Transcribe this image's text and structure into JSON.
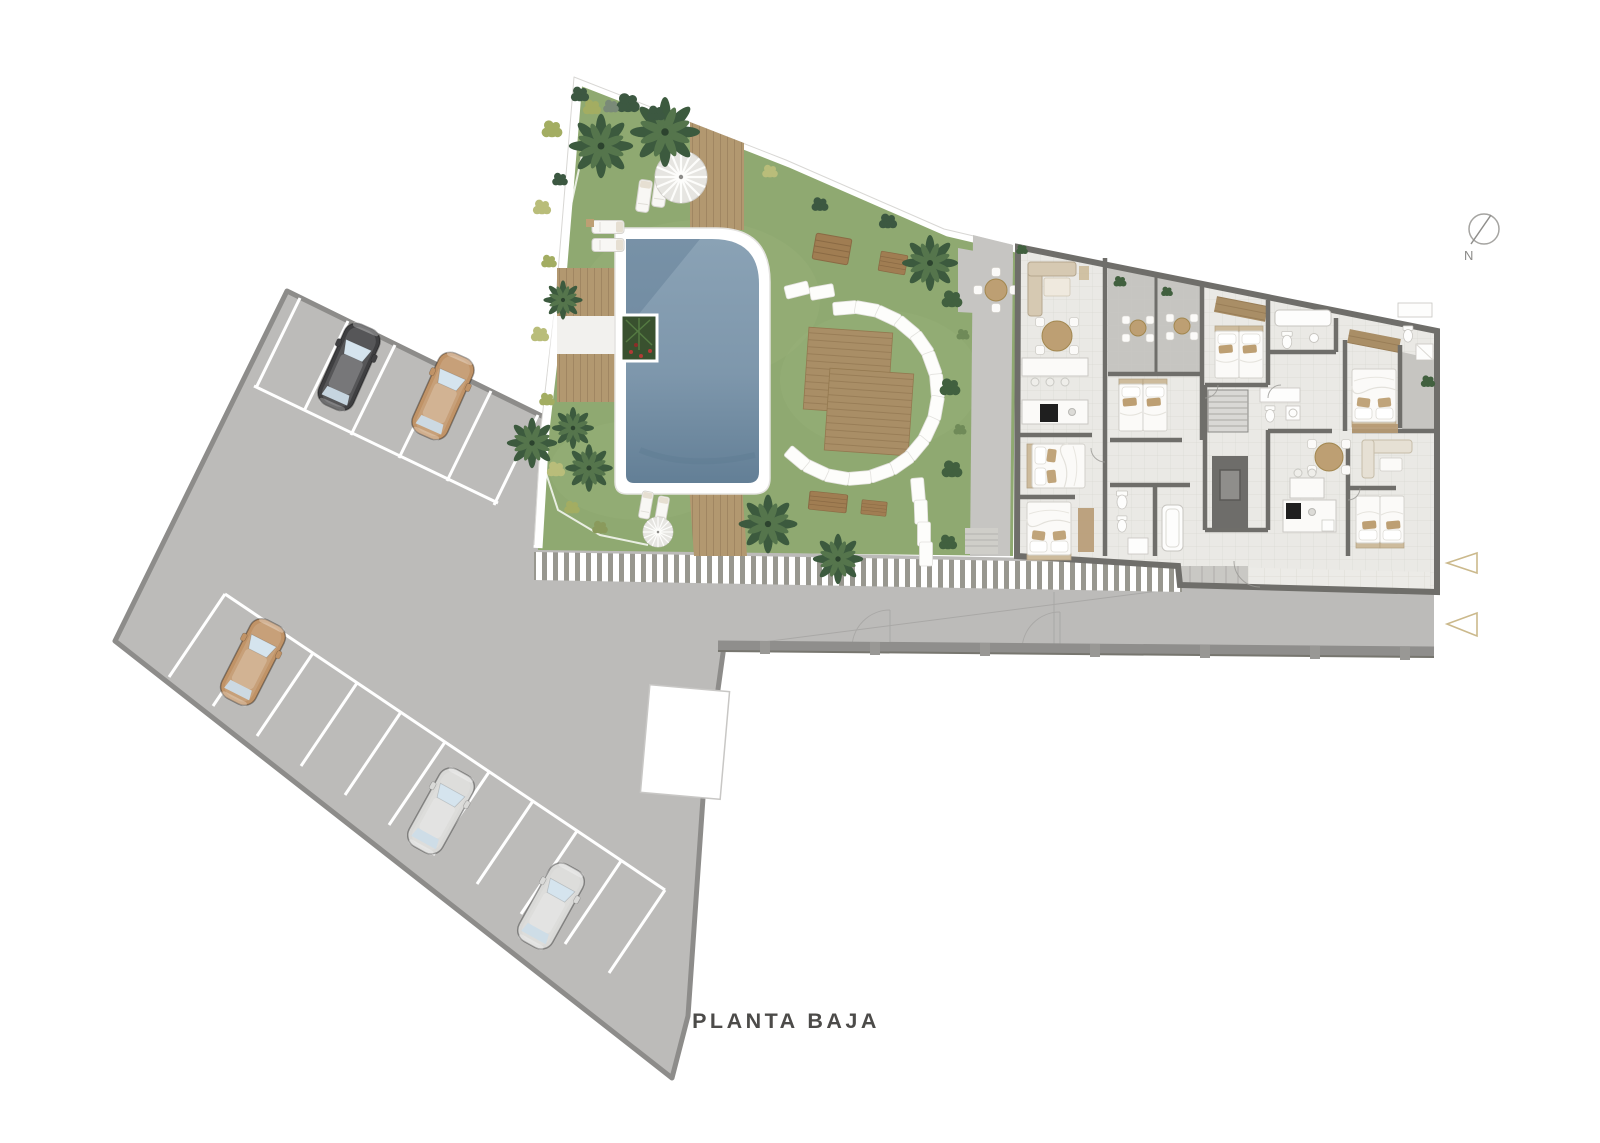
{
  "title": {
    "text": "PLANTA BAJA"
  },
  "compass": {
    "label": "N"
  },
  "palette": {
    "bg": "#ffffff",
    "title-color": "#4c4b49",
    "compass-color": "#8b8a88",
    "asphalt": "#bcbbb9",
    "asphalt_border": "#8d8c8a",
    "parking_line": "#ffffff",
    "lawn": "#8fa971",
    "gravel_path": "#c6c5c2",
    "deck_wood": "#b29870",
    "pool_water": "#7e97ac",
    "pool_coping": "#ffffff",
    "fence_stripe": "#98978f",
    "building_wall": "#6f6e6a",
    "building_floor": "#eae9e5",
    "terrace_floor": "#c6c5c1",
    "furniture_beige": "#d6c9b2",
    "furniture_tan": "#bd9f73",
    "palm_green": "#3c5a3e",
    "shrub_green": "#a3ad62",
    "stepping_stone": "#fdfdfb",
    "entrance_arrow": "#cbb98c",
    "car_dark": "#3f3f41",
    "car_tan": "#c09367",
    "car_silver": "#d9d9d7"
  },
  "parking": {
    "rows": [
      {
        "name": "top-row",
        "spaces": 6
      },
      {
        "name": "side-row",
        "spaces": 11
      }
    ],
    "cars": [
      {
        "id": "car-1",
        "color_name": "dark-gray",
        "hex": "#3f3f41"
      },
      {
        "id": "car-2",
        "color_name": "tan",
        "hex": "#c09367"
      },
      {
        "id": "car-3",
        "color_name": "tan",
        "hex": "#c09367"
      },
      {
        "id": "car-4",
        "color_name": "silver",
        "hex": "#d9d9d7"
      },
      {
        "id": "car-5",
        "color_name": "silver",
        "hex": "#d9d9d7"
      }
    ]
  },
  "garden": {
    "features": [
      "swimming-pool",
      "wood-deck-paths",
      "wood-platforms",
      "stepping-stone-arc",
      "parasols",
      "sun-loungers",
      "wood-benches",
      "palm-trees",
      "shrubs",
      "planter",
      "hedge-path"
    ],
    "parasol_count": 2,
    "lounger_count": 6
  },
  "building": {
    "features": [
      "apartments",
      "terraces-with-seating",
      "bedrooms",
      "bathrooms",
      "kitchens",
      "stair-core",
      "elevator",
      "tiled-entrance"
    ],
    "entrance_arrow_count": 2
  }
}
